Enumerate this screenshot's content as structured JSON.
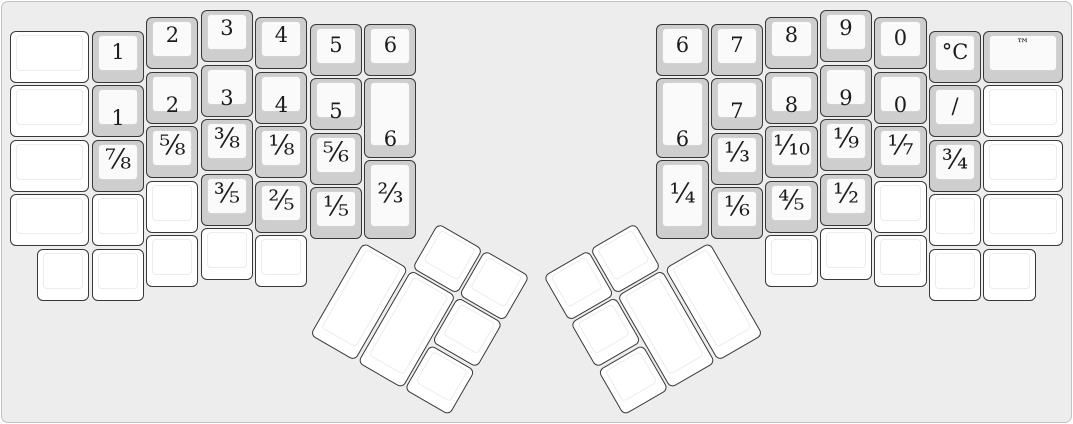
{
  "keyboard": {
    "unit": 54.5,
    "key_inset": 1.2,
    "colors": {
      "panel_bg": "#ededed",
      "panel_border": "#c2c2c2",
      "key_border": "#383838",
      "key_base_gray": "#cecece",
      "key_face_gray": "#fafafa",
      "key_face_border": "#d2d2d2",
      "key_white": "#ffffff",
      "white_face_border": "#ececec",
      "legend": "#1c1c1c"
    },
    "sections": [
      {
        "name": "left-main",
        "type": "grid",
        "origin": [
          9,
          9
        ],
        "keys": [
          {
            "x": 0,
            "y": 0.375,
            "w": 1.5,
            "h": 1,
            "label": ""
          },
          {
            "x": 0,
            "y": 1.375,
            "w": 1.5,
            "h": 1,
            "label": ""
          },
          {
            "x": 0,
            "y": 2.375,
            "w": 1.5,
            "h": 1,
            "label": ""
          },
          {
            "x": 0,
            "y": 3.375,
            "w": 1.5,
            "h": 1,
            "label": ""
          },
          {
            "x": 1.5,
            "y": 0.375,
            "w": 1,
            "h": 1,
            "label": "1",
            "pos": "center"
          },
          {
            "x": 1.5,
            "y": 1.375,
            "w": 1,
            "h": 1,
            "label": "1",
            "pos": "bottom"
          },
          {
            "x": 1.5,
            "y": 2.375,
            "w": 1,
            "h": 1,
            "label": "⅞",
            "pos": "center"
          },
          {
            "x": 1.5,
            "y": 3.375,
            "w": 1,
            "h": 1,
            "label": ""
          },
          {
            "x": 2.5,
            "y": 0.125,
            "w": 1,
            "h": 1,
            "label": "2",
            "pos": "top"
          },
          {
            "x": 2.5,
            "y": 1.125,
            "w": 1,
            "h": 1,
            "label": "2",
            "pos": "bottom"
          },
          {
            "x": 2.5,
            "y": 2.125,
            "w": 1,
            "h": 1,
            "label": "⅝",
            "pos": "center"
          },
          {
            "x": 2.5,
            "y": 3.125,
            "w": 1,
            "h": 1,
            "label": ""
          },
          {
            "x": 3.5,
            "y": 0,
            "w": 1,
            "h": 1,
            "label": "3",
            "pos": "top"
          },
          {
            "x": 3.5,
            "y": 1,
            "w": 1,
            "h": 1,
            "label": "3",
            "pos": "bottom"
          },
          {
            "x": 3.5,
            "y": 2,
            "w": 1,
            "h": 1,
            "label": "⅜",
            "pos": "center"
          },
          {
            "x": 3.5,
            "y": 3,
            "w": 1,
            "h": 1,
            "label": "⅗",
            "pos": "center"
          },
          {
            "x": 4.5,
            "y": 0.125,
            "w": 1,
            "h": 1,
            "label": "4",
            "pos": "top"
          },
          {
            "x": 4.5,
            "y": 1.125,
            "w": 1,
            "h": 1,
            "label": "4",
            "pos": "bottom"
          },
          {
            "x": 4.5,
            "y": 2.125,
            "w": 1,
            "h": 1,
            "label": "⅛",
            "pos": "center"
          },
          {
            "x": 4.5,
            "y": 3.125,
            "w": 1,
            "h": 1,
            "label": "⅖",
            "pos": "center"
          },
          {
            "x": 5.5,
            "y": 0.25,
            "w": 1,
            "h": 1,
            "label": "5",
            "pos": "center"
          },
          {
            "x": 5.5,
            "y": 1.25,
            "w": 1,
            "h": 1,
            "label": "5",
            "pos": "bottom"
          },
          {
            "x": 5.5,
            "y": 2.25,
            "w": 1,
            "h": 1,
            "label": "⅚",
            "pos": "center"
          },
          {
            "x": 5.5,
            "y": 3.25,
            "w": 1,
            "h": 1,
            "label": "⅕",
            "pos": "center"
          },
          {
            "x": 6.5,
            "y": 0.25,
            "w": 1,
            "h": 1,
            "label": "6",
            "pos": "center"
          },
          {
            "x": 6.5,
            "y": 1.25,
            "w": 1,
            "h": 1.5,
            "label": "6",
            "pos": "bottom"
          },
          {
            "x": 6.5,
            "y": 2.75,
            "w": 1,
            "h": 1.5,
            "label": "⅔",
            "pos": "center"
          },
          {
            "x": 0.5,
            "y": 4.375,
            "w": 1,
            "h": 1,
            "label": ""
          },
          {
            "x": 1.5,
            "y": 4.375,
            "w": 1,
            "h": 1,
            "label": ""
          },
          {
            "x": 2.5,
            "y": 4.125,
            "w": 1,
            "h": 1,
            "label": ""
          },
          {
            "x": 3.5,
            "y": 4,
            "w": 1,
            "h": 1,
            "label": ""
          },
          {
            "x": 4.5,
            "y": 4.125,
            "w": 1,
            "h": 1,
            "label": ""
          }
        ]
      },
      {
        "name": "right-main",
        "type": "grid",
        "origin": [
          655.25,
          9
        ],
        "keys": [
          {
            "x": 0,
            "y": 0.25,
            "w": 1,
            "h": 1,
            "label": "6",
            "pos": "center"
          },
          {
            "x": 0,
            "y": 1.25,
            "w": 1,
            "h": 1.5,
            "label": "6",
            "pos": "bottom"
          },
          {
            "x": 0,
            "y": 2.75,
            "w": 1,
            "h": 1.5,
            "label": "¼",
            "pos": "center"
          },
          {
            "x": 1,
            "y": 0.25,
            "w": 1,
            "h": 1,
            "label": "7",
            "pos": "center"
          },
          {
            "x": 1,
            "y": 1.25,
            "w": 1,
            "h": 1,
            "label": "7",
            "pos": "bottom"
          },
          {
            "x": 1,
            "y": 2.25,
            "w": 1,
            "h": 1,
            "label": "⅓",
            "pos": "center"
          },
          {
            "x": 1,
            "y": 3.25,
            "w": 1,
            "h": 1,
            "label": "⅙",
            "pos": "center"
          },
          {
            "x": 2,
            "y": 0.125,
            "w": 1,
            "h": 1,
            "label": "8",
            "pos": "top"
          },
          {
            "x": 2,
            "y": 1.125,
            "w": 1,
            "h": 1,
            "label": "8",
            "pos": "bottom"
          },
          {
            "x": 2,
            "y": 2.125,
            "w": 1,
            "h": 1,
            "label": "⅒",
            "pos": "center"
          },
          {
            "x": 2,
            "y": 3.125,
            "w": 1,
            "h": 1,
            "label": "⅘",
            "pos": "center"
          },
          {
            "x": 3,
            "y": 0,
            "w": 1,
            "h": 1,
            "label": "9",
            "pos": "top"
          },
          {
            "x": 3,
            "y": 1,
            "w": 1,
            "h": 1,
            "label": "9",
            "pos": "bottom"
          },
          {
            "x": 3,
            "y": 2,
            "w": 1,
            "h": 1,
            "label": "⅑",
            "pos": "center"
          },
          {
            "x": 3,
            "y": 3,
            "w": 1,
            "h": 1,
            "label": "½",
            "pos": "center"
          },
          {
            "x": 4,
            "y": 0.125,
            "w": 1,
            "h": 1,
            "label": "0",
            "pos": "center"
          },
          {
            "x": 4,
            "y": 1.125,
            "w": 1,
            "h": 1,
            "label": "0",
            "pos": "bottom"
          },
          {
            "x": 4,
            "y": 2.125,
            "w": 1,
            "h": 1,
            "label": "⅐",
            "pos": "center"
          },
          {
            "x": 4,
            "y": 3.125,
            "w": 1,
            "h": 1,
            "label": ""
          },
          {
            "x": 5,
            "y": 0.375,
            "w": 1,
            "h": 1,
            "label": "°C",
            "pos": "center"
          },
          {
            "x": 5,
            "y": 1.375,
            "w": 1,
            "h": 1,
            "label": "/",
            "pos": "center"
          },
          {
            "x": 5,
            "y": 2.375,
            "w": 1,
            "h": 1,
            "label": "¾",
            "pos": "center"
          },
          {
            "x": 5,
            "y": 3.375,
            "w": 1,
            "h": 1,
            "label": ""
          },
          {
            "x": 6,
            "y": 0.375,
            "w": 1.5,
            "h": 1,
            "label": "™",
            "pos": "top"
          },
          {
            "x": 6,
            "y": 1.375,
            "w": 1.5,
            "h": 1,
            "label": ""
          },
          {
            "x": 6,
            "y": 2.375,
            "w": 1.5,
            "h": 1,
            "label": ""
          },
          {
            "x": 6,
            "y": 3.375,
            "w": 1.5,
            "h": 1,
            "label": ""
          },
          {
            "x": 2,
            "y": 4.125,
            "w": 1,
            "h": 1,
            "label": ""
          },
          {
            "x": 3,
            "y": 4,
            "w": 1,
            "h": 1,
            "label": ""
          },
          {
            "x": 4,
            "y": 4.125,
            "w": 1,
            "h": 1,
            "label": ""
          },
          {
            "x": 5,
            "y": 4.375,
            "w": 1,
            "h": 1,
            "label": ""
          },
          {
            "x": 6,
            "y": 4.375,
            "w": 1,
            "h": 1,
            "label": ""
          }
        ]
      },
      {
        "name": "left-thumb",
        "type": "rotated",
        "pivot": [
          363.25,
          240.625
        ],
        "angle": 30,
        "keys": [
          {
            "x": 1,
            "y": -1,
            "w": 1,
            "h": 1,
            "label": ""
          },
          {
            "x": 2,
            "y": -1,
            "w": 1,
            "h": 1,
            "label": ""
          },
          {
            "x": 0,
            "y": 0,
            "w": 1,
            "h": 2,
            "label": ""
          },
          {
            "x": 1,
            "y": 0,
            "w": 1,
            "h": 2,
            "label": ""
          },
          {
            "x": 2,
            "y": 0,
            "w": 1,
            "h": 1,
            "label": ""
          },
          {
            "x": 2,
            "y": 1,
            "w": 1,
            "h": 1,
            "label": ""
          }
        ]
      },
      {
        "name": "right-thumb",
        "type": "rotated",
        "pivot": [
          709.75,
          240.625
        ],
        "angle": -30,
        "keys": [
          {
            "x": -2,
            "y": -1,
            "w": 1,
            "h": 1,
            "label": ""
          },
          {
            "x": -3,
            "y": -1,
            "w": 1,
            "h": 1,
            "label": ""
          },
          {
            "x": -1,
            "y": 0,
            "w": 1,
            "h": 2,
            "label": ""
          },
          {
            "x": -2,
            "y": 0,
            "w": 1,
            "h": 2,
            "label": ""
          },
          {
            "x": -3,
            "y": 0,
            "w": 1,
            "h": 1,
            "label": ""
          },
          {
            "x": -3,
            "y": 1,
            "w": 1,
            "h": 1,
            "label": ""
          }
        ]
      }
    ]
  }
}
